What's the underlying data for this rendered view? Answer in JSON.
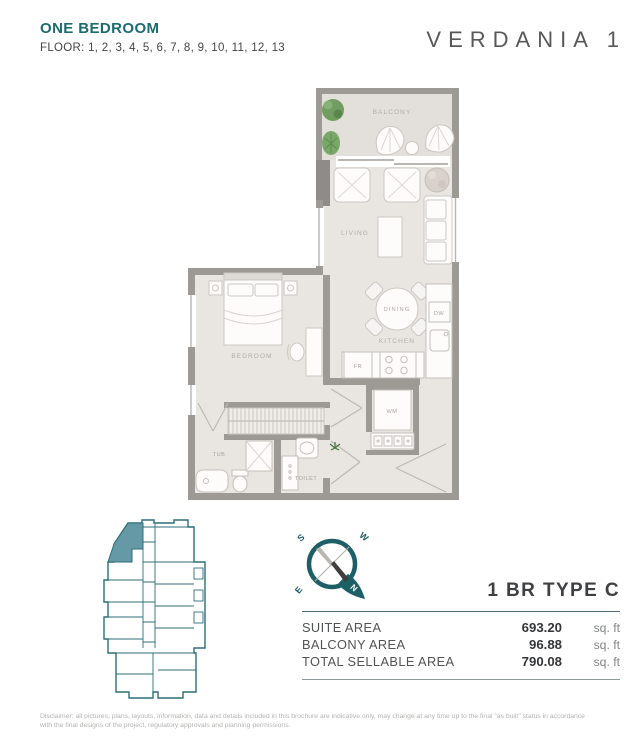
{
  "header": {
    "title": "ONE BEDROOM",
    "floors_label": "FLOOR: 1, 2, 3, 4, 5, 6, 7, 8, 9, 10, 11, 12, 13",
    "brand": "VERDANIA 1"
  },
  "plan": {
    "labels": {
      "balcony": "BALCONY",
      "living": "LIVING",
      "dining": "DINING",
      "kitchen": "KITCHEN",
      "bedroom": "BEDROOM",
      "tub": "TUB",
      "toilet": "TOILET",
      "fr": "FR",
      "dw": "DW",
      "wm": "WM"
    }
  },
  "compass": {
    "north": "N",
    "south": "S",
    "east": "E",
    "west": "W"
  },
  "unit": {
    "type_label": "1 BR TYPE C",
    "areas": [
      {
        "label": "SUITE AREA",
        "value": "693.20",
        "unit": "sq. ft"
      },
      {
        "label": "BALCONY AREA",
        "value": "96.88",
        "unit": "sq. ft"
      },
      {
        "label": "TOTAL SELLABLE AREA",
        "value": "790.08",
        "unit": "sq. ft"
      }
    ]
  },
  "footer": {
    "disclaimer_line1": "Disclaimer: all pictures, plans, layouts, information, data and details included in this brochure are indicative only, may change at any time up to the final \"as built\" status in accordance",
    "disclaimer_line2": "with the final designs of the project, regulatory approvals and planning permissions."
  },
  "colors": {
    "brand_teal": "#1c6b6e",
    "keyplan_teal": "#2d6e79",
    "unit_highlight": "#6699a6",
    "wall_gray": "#9d9a96",
    "floor_gray": "#e9e5e1",
    "balcony_floor": "#e3dfdb"
  }
}
